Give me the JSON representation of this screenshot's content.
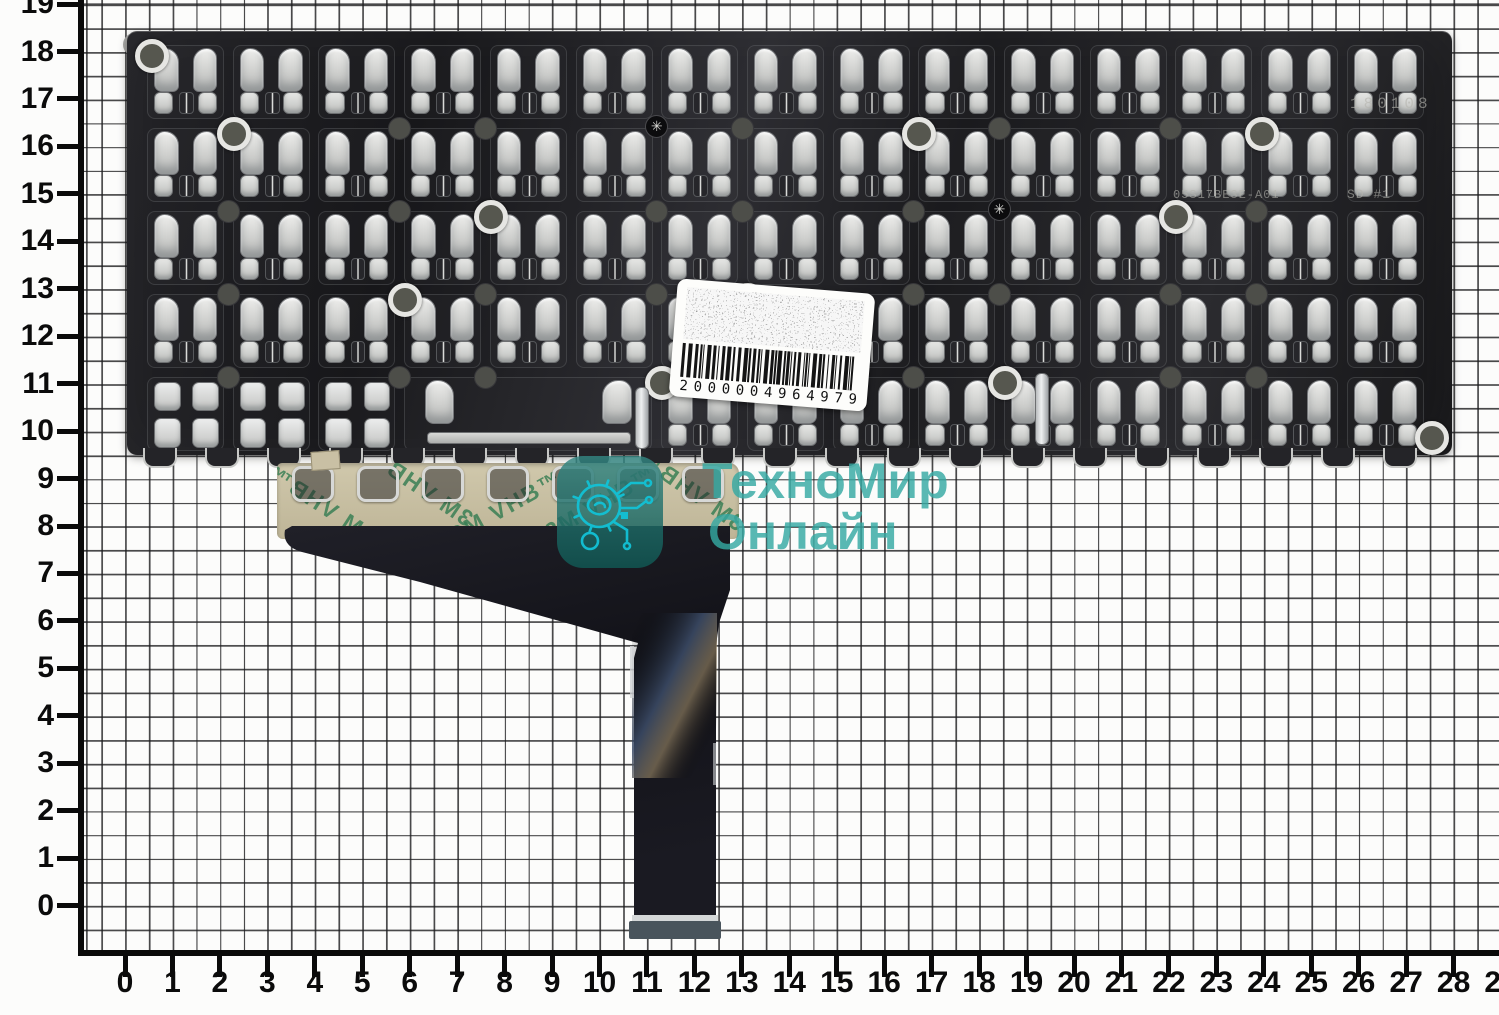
{
  "colors": {
    "teal_text": "rgba(52,168,162,0.82)",
    "icon_bg": "rgba(23,118,112,0.8)",
    "icon_line": "#12c2d6",
    "green_print": "#3a7f55",
    "strip_tan": "#c8bfa2",
    "plate_dark": "#1c1c1f"
  },
  "ruler": {
    "x_labels": [
      "0",
      "1",
      "2",
      "3",
      "4",
      "5",
      "6",
      "7",
      "8",
      "9",
      "10",
      "11",
      "12",
      "13",
      "14",
      "15",
      "16",
      "17",
      "18",
      "19",
      "20",
      "21",
      "22",
      "23",
      "24",
      "25",
      "26",
      "27",
      "28",
      "29"
    ],
    "y_labels": [
      "0",
      "1",
      "2",
      "3",
      "4",
      "5",
      "6",
      "7",
      "8",
      "9",
      "10",
      "11",
      "12",
      "13",
      "14",
      "15",
      "16",
      "17",
      "18",
      "19"
    ]
  },
  "watermark": {
    "line1": "ТехноМир",
    "line2": "Онлайн"
  },
  "barcode": {
    "number": "2000004964979"
  },
  "plate": {
    "stamps": [
      {
        "text": "180108",
        "x": 1350,
        "y": 95,
        "size": 16,
        "ls": 4
      },
      {
        "text": "05S17BE3E-A01",
        "x": 1173,
        "y": 188,
        "size": 12,
        "ls": 1
      },
      {
        "text": "SD #1",
        "x": 1347,
        "y": 187,
        "size": 13,
        "ls": 1
      }
    ],
    "screw_glyph": "✳",
    "rows": 5,
    "cols": 15
  },
  "adhesive": {
    "text": "3M VHB™",
    "marks": [
      {
        "x": -18,
        "y": 28,
        "rot": -33,
        "mirror": true
      },
      {
        "x": 80,
        "y": 10,
        "rot": -34,
        "mirror": true
      },
      {
        "x": 168,
        "y": 30,
        "rot": -29,
        "mirror": false
      },
      {
        "x": 262,
        "y": 26,
        "rot": -30,
        "mirror": false
      },
      {
        "x": 352,
        "y": 14,
        "rot": -35,
        "mirror": true
      },
      {
        "x": 420,
        "y": 30,
        "rot": -62,
        "mirror": true
      }
    ]
  }
}
